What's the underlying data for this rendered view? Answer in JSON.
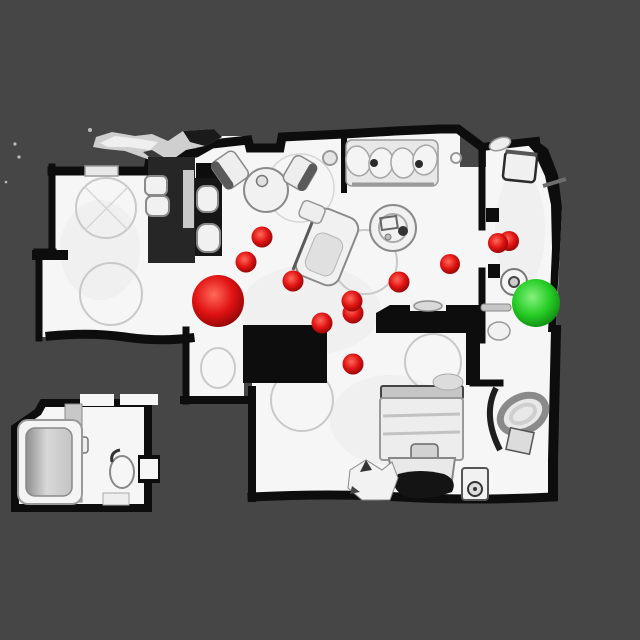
{
  "scene": {
    "view": "top-down-3d-scan-floorplan",
    "canvas_width": 640,
    "canvas_height": 640,
    "colors": {
      "background": "#464646",
      "floor": "#f6f6f6",
      "walls": "#0d0d0d"
    }
  },
  "markers": {
    "red_sphere_colors": {
      "highlight": "#ff6a5a",
      "mid": "#e01212",
      "edge": "#7d0404"
    },
    "green_sphere_colors": {
      "highlight": "#86f07e",
      "mid": "#27ce27",
      "edge": "#0b7c0b"
    },
    "small_red_spheres": [
      {
        "cx": 246,
        "cy": 262,
        "r": 10.5
      },
      {
        "cx": 262,
        "cy": 237,
        "r": 10.5
      },
      {
        "cx": 293,
        "cy": 281,
        "r": 10.5
      },
      {
        "cx": 399,
        "cy": 282,
        "r": 10.5
      },
      {
        "cx": 450,
        "cy": 264,
        "r": 10
      },
      {
        "cx": 509,
        "cy": 241,
        "r": 10
      },
      {
        "cx": 498,
        "cy": 243,
        "r": 10
      },
      {
        "cx": 353,
        "cy": 313,
        "r": 10.5
      },
      {
        "cx": 352,
        "cy": 301,
        "r": 10.5
      },
      {
        "cx": 322,
        "cy": 323,
        "r": 10.5
      },
      {
        "cx": 353,
        "cy": 364,
        "r": 10.5
      }
    ],
    "large_red_sphere": {
      "cx": 218,
      "cy": 301,
      "r": 26
    },
    "green_sphere": {
      "cx": 536,
      "cy": 303,
      "r": 24
    }
  }
}
